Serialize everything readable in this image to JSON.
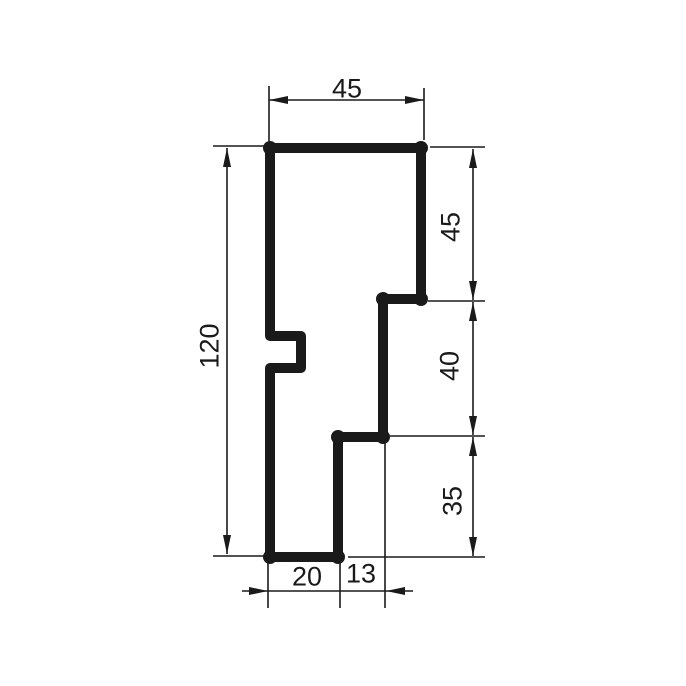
{
  "drawing": {
    "type": "technical-profile-cross-section",
    "canvas": {
      "width": 686,
      "height": 686
    },
    "colors": {
      "ink": "#1a1a1a",
      "background": "#ffffff"
    },
    "measurements": {
      "top_width": "45",
      "right_upper": "45",
      "right_middle": "40",
      "right_lower": "35",
      "left_total_height": "120",
      "bottom_left": "20",
      "bottom_right": "13"
    },
    "profile": {
      "stroke_width": 10,
      "corner_dot_radius": 7,
      "points": [
        [
          270,
          148
        ],
        [
          421,
          148
        ],
        [
          421,
          299
        ],
        [
          383,
          299
        ],
        [
          383,
          437
        ],
        [
          338,
          437
        ],
        [
          338,
          557
        ],
        [
          270,
          557
        ],
        [
          270,
          368
        ],
        [
          301,
          368
        ],
        [
          301,
          336
        ],
        [
          270,
          336
        ]
      ],
      "corner_dots": [
        [
          270,
          148
        ],
        [
          421,
          148
        ],
        [
          421,
          299
        ],
        [
          383,
          299
        ],
        [
          383,
          437
        ],
        [
          338,
          437
        ],
        [
          338,
          557
        ],
        [
          270,
          557
        ]
      ]
    },
    "thin_stroke_width": 1.6,
    "arrow": {
      "length": 19,
      "half_width": 4
    },
    "dimensions": [
      {
        "name": "top-width",
        "value": "45",
        "text": {
          "x": 347,
          "y": 88,
          "rotate": 0
        },
        "lines": [
          [
            269,
            100,
            424,
            100
          ]
        ],
        "ext": [
          [
            269,
            86,
            269,
            141
          ],
          [
            424,
            88,
            424,
            140
          ]
        ],
        "arrows": [
          {
            "x": 269,
            "y": 100,
            "dir": "left"
          },
          {
            "x": 424,
            "y": 100,
            "dir": "right"
          }
        ]
      },
      {
        "name": "right-upper",
        "value": "45",
        "text": {
          "x": 450,
          "y": 227,
          "rotate": -90
        },
        "lines": [
          [
            473,
            149,
            473,
            300
          ]
        ],
        "ext": [
          [
            430,
            147,
            485,
            147
          ],
          [
            428,
            301,
            485,
            301
          ]
        ],
        "arrows": [
          {
            "x": 473,
            "y": 149,
            "dir": "up"
          },
          {
            "x": 473,
            "y": 300,
            "dir": "down"
          }
        ]
      },
      {
        "name": "right-middle",
        "value": "40",
        "text": {
          "x": 449,
          "y": 366,
          "rotate": -90
        },
        "lines": [
          [
            473,
            302,
            473,
            435
          ]
        ],
        "ext": [
          [
            390,
            436,
            485,
            436
          ]
        ],
        "arrows": [
          {
            "x": 473,
            "y": 302,
            "dir": "up"
          },
          {
            "x": 473,
            "y": 435,
            "dir": "down"
          }
        ]
      },
      {
        "name": "right-lower",
        "value": "35",
        "text": {
          "x": 452,
          "y": 501,
          "rotate": -90
        },
        "lines": [
          [
            473,
            437,
            473,
            556
          ]
        ],
        "ext": [
          [
            348,
            557,
            485,
            557
          ]
        ],
        "arrows": [
          {
            "x": 473,
            "y": 437,
            "dir": "up"
          },
          {
            "x": 473,
            "y": 556,
            "dir": "down"
          }
        ]
      },
      {
        "name": "left-total-height",
        "value": "120",
        "text": {
          "x": 209,
          "y": 346,
          "rotate": -90
        },
        "lines": [
          [
            227,
            148,
            227,
            554
          ]
        ],
        "ext": [
          [
            213,
            146,
            267,
            146
          ],
          [
            213,
            556,
            267,
            556
          ]
        ],
        "arrows": [
          {
            "x": 227,
            "y": 148,
            "dir": "up"
          },
          {
            "x": 227,
            "y": 554,
            "dir": "down"
          }
        ]
      },
      {
        "name": "bottom-left",
        "value": "20",
        "text": {
          "x": 307,
          "y": 576,
          "rotate": 0
        },
        "lines": [
          [
            242,
            591,
            413,
            591
          ]
        ],
        "ext": [
          [
            268,
            563,
            268,
            608
          ],
          [
            340,
            563,
            340,
            608
          ]
        ],
        "arrows": [
          {
            "x": 268,
            "y": 591,
            "dir": "right"
          },
          {
            "x": 386,
            "y": 591,
            "dir": "left"
          }
        ]
      },
      {
        "name": "bottom-right",
        "value": "13",
        "text": {
          "x": 361,
          "y": 573,
          "rotate": 0
        },
        "lines": [],
        "ext": [
          [
            385,
            443,
            385,
            608
          ]
        ],
        "arrows": []
      }
    ]
  }
}
